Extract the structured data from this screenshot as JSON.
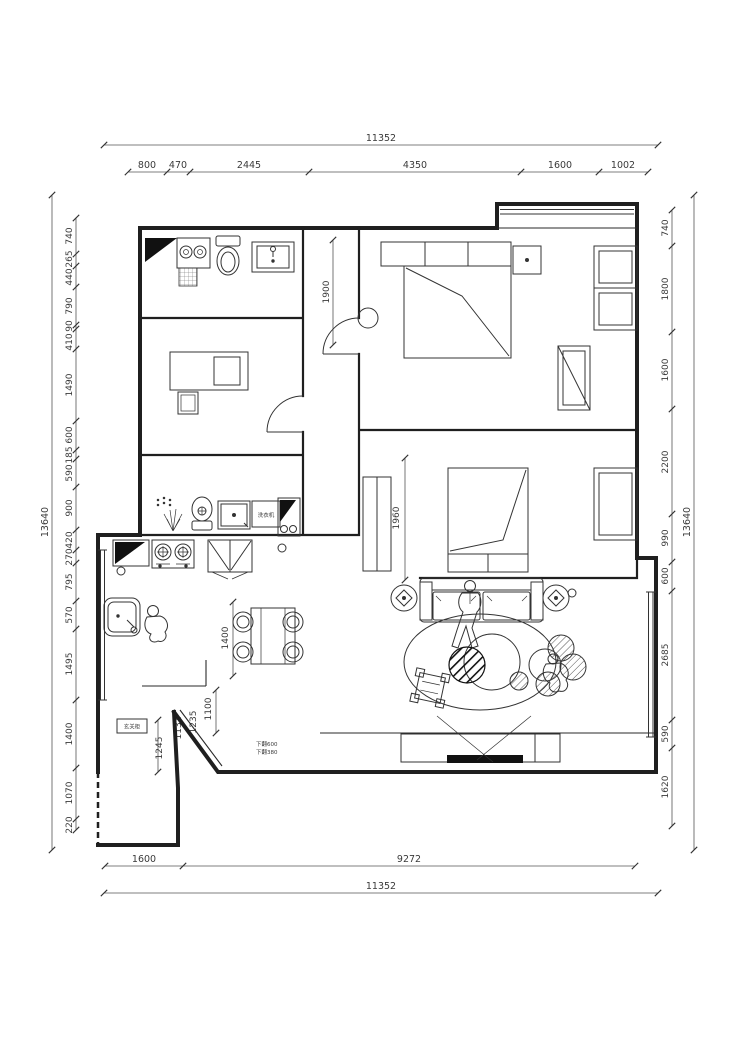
{
  "dims": {
    "top": {
      "overall": "11352",
      "segments": [
        "800",
        "470",
        "2445",
        "4350",
        "1600",
        "1002"
      ]
    },
    "bottom": {
      "overall": "11352",
      "segments": [
        "1600",
        "9272"
      ]
    },
    "left": {
      "overall": "13640",
      "segments": [
        "740",
        "265",
        "440",
        "790",
        "90",
        "410",
        "1490",
        "600",
        "185",
        "590",
        "900",
        "420",
        "270",
        "795",
        "570",
        "1495",
        "1400",
        "1070",
        "220"
      ]
    },
    "right": {
      "overall": "13640",
      "segments": [
        "740",
        "1800",
        "1600",
        "2200",
        "990",
        "600",
        "2685",
        "590",
        "1620"
      ]
    },
    "interior": {
      "hall": "1900",
      "bedroom": "1960",
      "dining": "1400",
      "entry1": "1100",
      "entry2": "1235",
      "entry3": "1131",
      "entry4": "1245"
    }
  },
  "labels": {
    "washing_machine": "洗衣机",
    "entry_cabinet": "玄关柜",
    "ceiling_note_1": "下翻600",
    "ceiling_note_2": "下翻380"
  },
  "colors": {
    "wall": "#1f1f1f",
    "line": "#333333",
    "dim": "#555555",
    "bg": "#ffffff"
  }
}
